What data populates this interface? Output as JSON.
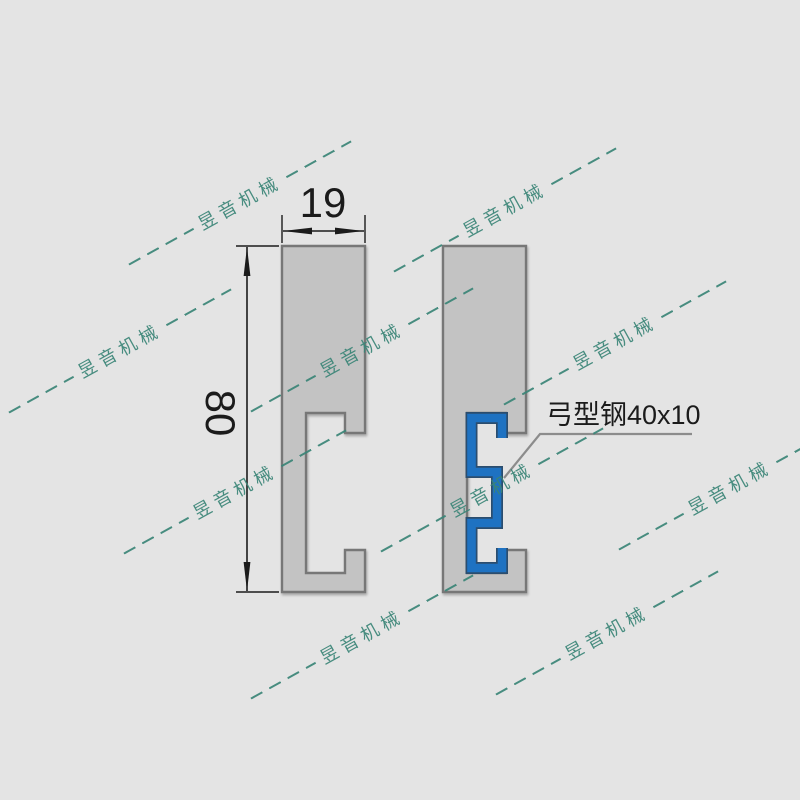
{
  "colors": {
    "background": "#e4e4e4",
    "profile_fill": "#c3c3c3",
    "profile_stroke": "#777777",
    "insert_blue": "#1e72c2",
    "insert_blue_edge": "#2b4d6e",
    "dimension": "#1b1b1b",
    "leader": "#8c8c8c",
    "watermark": "#3a8577"
  },
  "dimensions": {
    "width_label": "19",
    "height_label": "80"
  },
  "callout": {
    "label": "弓型钢40x10"
  },
  "watermark": {
    "text": "昱音机械"
  }
}
